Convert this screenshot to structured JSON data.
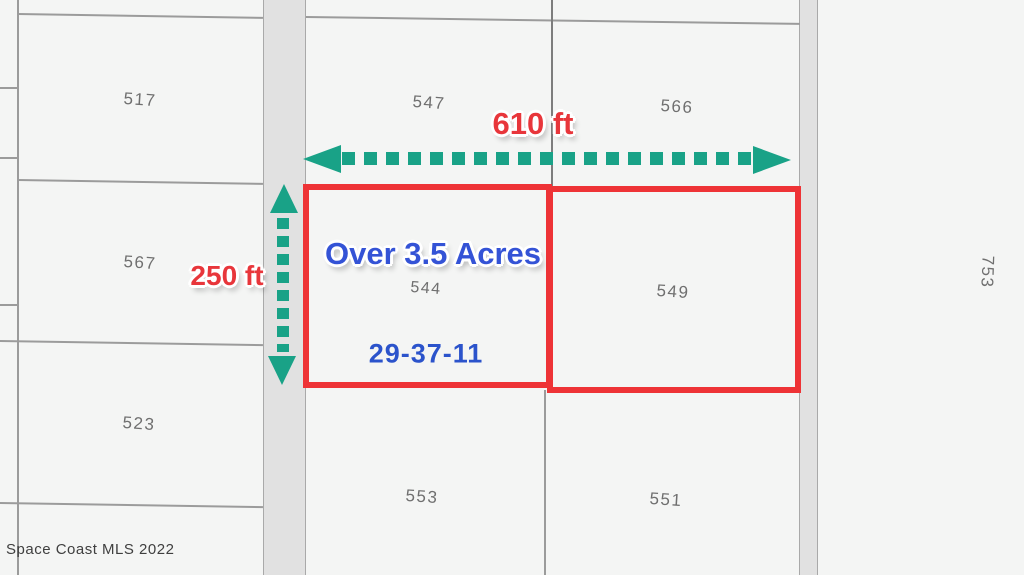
{
  "parcels": {
    "p517": "517",
    "p547": "547",
    "p566": "566",
    "p567": "567",
    "p544": "544",
    "p549": "549",
    "p753": "753",
    "p523": "523",
    "p553": "553",
    "p551": "551"
  },
  "dimensions": {
    "width_label": "610 ft",
    "height_label": "250 ft"
  },
  "callouts": {
    "acreage": "Over 3.5 Acres",
    "section_township_range": "29-37-11"
  },
  "watermark": "Space Coast MLS 2022",
  "colors": {
    "dimension_red": "#e8363b",
    "highlight_red": "#ee3336",
    "arrow_teal": "#19a287",
    "acreage_blue": "#3453d6",
    "section_blue": "#2b53cb",
    "parcel_gray": "#6f6f6f",
    "line_gray": "#9b9b9b",
    "road_edge_gray": "#a9a9a9",
    "road_fill": "#e1e1e1",
    "parcel_fill": "#f4f5f4",
    "watermark_gray": "#3f3f3f"
  }
}
